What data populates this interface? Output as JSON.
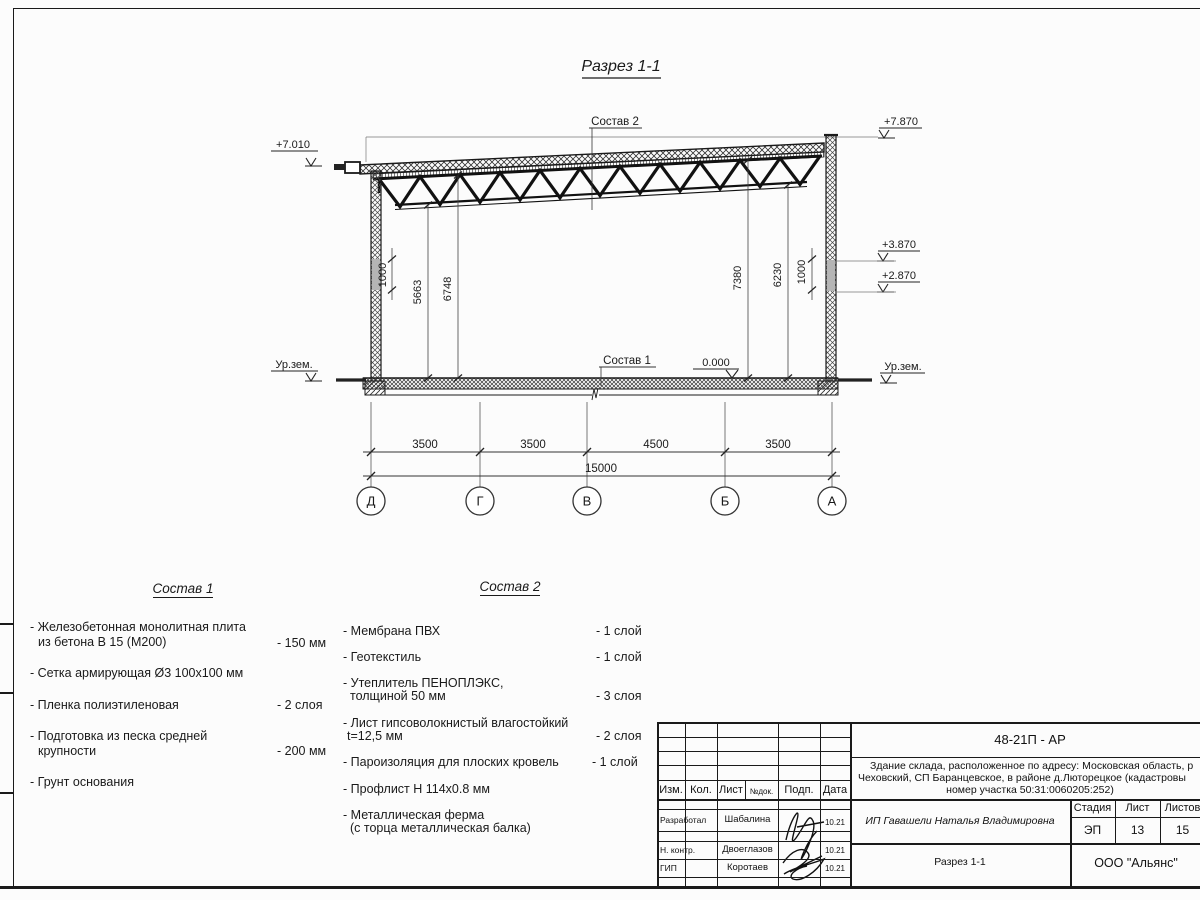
{
  "sheet": {
    "title": "Разрез 1-1",
    "leaders": {
      "comp2": "Состав 2",
      "comp1": "Состав 1"
    },
    "elevations": {
      "left_top": "+7.010",
      "right_top": "+7.870",
      "right_mid_upper": "+3.870",
      "right_mid_lower": "+2.870",
      "floor_zero": "0.000",
      "ground_left": "Ур.зем.",
      "ground_right": "Ур.зем."
    },
    "dims": {
      "wall_left": "1000",
      "left_to_bottom_chord": "5663",
      "left_to_top_chord": "6748",
      "right_to_top_chord": "7380",
      "right_to_bottom_chord": "6230",
      "wall_right": "1000",
      "segments": [
        "3500",
        "3500",
        "4500",
        "3500"
      ],
      "total": "15000"
    },
    "axes": [
      "Д",
      "Г",
      "В",
      "Б",
      "А"
    ]
  },
  "comp1": {
    "title": "Состав 1",
    "items": [
      {
        "line1": "- Железобетонная  монолитная плита",
        "line2": "из бетона В 15 (М200)",
        "value": "- 150 мм"
      },
      {
        "line1": "- Сетка армирующая Ø3 100х100 мм",
        "line2": "",
        "value": ""
      },
      {
        "line1": "- Пленка полиэтиленовая",
        "line2": "",
        "value": "-  2 слоя"
      },
      {
        "line1": "- Подготовка из песка средней",
        "line2": "крупности",
        "value": "- 200 мм"
      },
      {
        "line1": "- Грунт основания",
        "line2": "",
        "value": ""
      }
    ]
  },
  "comp2": {
    "title": "Состав 2",
    "items": [
      {
        "line1": "- Мембрана ПВХ",
        "line2": "",
        "value": "- 1 слой"
      },
      {
        "line1": "- Геотекстиль",
        "line2": "",
        "value": "- 1 слой"
      },
      {
        "line1": "- Утеплитель ПЕНОПЛЭКС,",
        "line2": "толщиной 50 мм",
        "value": "- 3 слоя"
      },
      {
        "line1": "- Лист гипсоволокнистый влагостойкий",
        "line2": "t=12,5 мм",
        "value": "- 2 слоя"
      },
      {
        "line1": "- Пароизоляция для плоских кровель",
        "line2": "",
        "value": "- 1 слой"
      },
      {
        "line1": "- Профлист Н 114х0.8 мм",
        "line2": "",
        "value": ""
      },
      {
        "line1": "- Металлическая ферма",
        "line2": "(с торца металлическая балка)",
        "value": ""
      }
    ]
  },
  "titleblock": {
    "doc_number": "48-21П - АР",
    "description_line1": "Здание склада, расположенное по адресу: Московская область, р",
    "description_line2": "Чеховский, СП Баранцевское, в районе д.Люторецкое  (кадастровы",
    "description_line3": "номер участка 50:31:0060205:252)",
    "client": "ИП Гавашели Наталья Владимировна",
    "sheet_title": "Разрез 1-1",
    "company": "ООО \"Альянс\"",
    "header": {
      "izm": "Изм.",
      "kol": "Кол.",
      "list": "Лист",
      "ndok": "№док.",
      "podp": "Подп.",
      "data": "Дата"
    },
    "stage_label": "Стадия",
    "sheet_label": "Лист",
    "sheets_label": "Листов",
    "stage_value": "ЭП",
    "sheet_value": "13",
    "sheets_value": "15",
    "rows": [
      {
        "role": "Разработал",
        "name": "Шабалина",
        "date": "10.21"
      },
      {
        "role": "Н. контр.",
        "name": "Двоеглазов",
        "date": "10.21"
      },
      {
        "role": "ГИП",
        "name": "Коротаев",
        "date": "10.21"
      }
    ]
  }
}
